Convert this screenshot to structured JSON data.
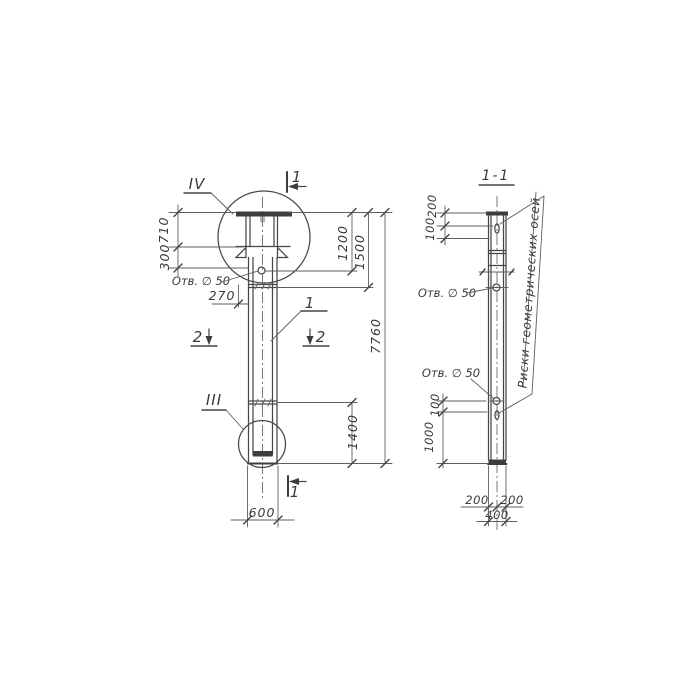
{
  "page": {
    "background": "#ffffff",
    "ink": "#3d3d3d"
  },
  "left_view": {
    "detail_labels": {
      "top": "IV",
      "bottom": "III"
    },
    "section_marks": {
      "top": "1",
      "bottom": "1",
      "left": "2",
      "right": "2"
    },
    "position_callout": "1",
    "hole_note": "Отв. ∅ 50",
    "dims": {
      "cap_height": "710",
      "corbel": "300",
      "hole_offset": "270",
      "top_to_hole": "1200",
      "top_to_joint": "1500",
      "lower_segment": "1400",
      "total_height": "7760",
      "width": "600"
    }
  },
  "right_view": {
    "title": "1-1",
    "hole_note_upper": "Отв. ∅ 50",
    "hole_note_lower": "Отв. ∅ 50",
    "axes_note": "Риски геометрических осей",
    "dims": {
      "top_to_mark": "200",
      "mark_to_axis": "100",
      "hole_to_mark": "100",
      "mark_to_bottom": "1000",
      "half_width_left": "200",
      "half_width_right": "200",
      "width": "400"
    }
  }
}
